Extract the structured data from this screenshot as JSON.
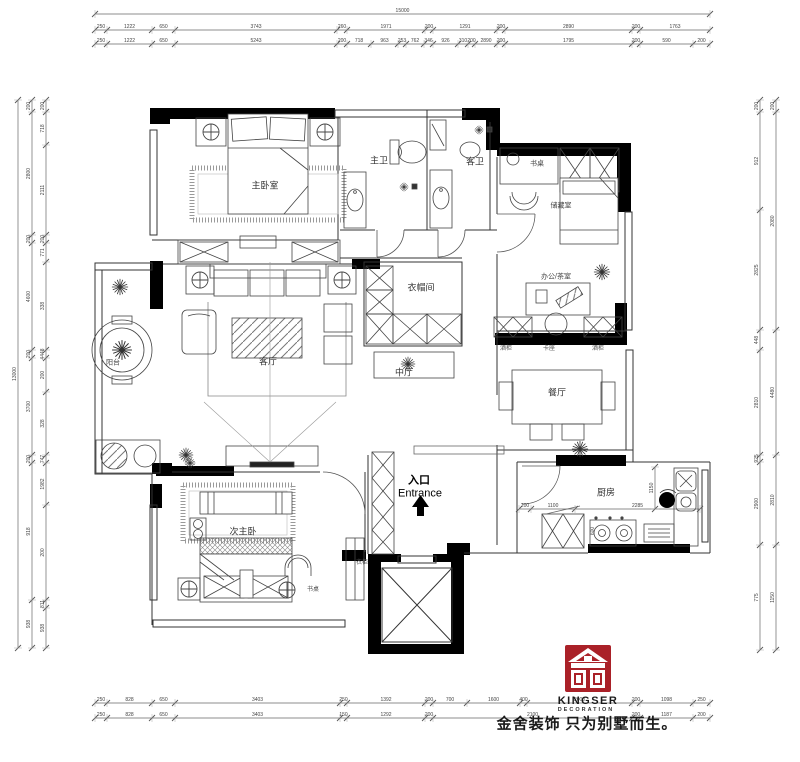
{
  "labels": {
    "master_bedroom": "主卧室",
    "master_bath": "主卫",
    "guest_bath": "客卫",
    "desk_top": "书桌",
    "storage_room": "储藏室",
    "cloakroom": "衣帽间",
    "office_tea": "办公/茶室",
    "living_room": "客厅",
    "mid_hall": "中厅",
    "wine_cabinet_left": "酒柜",
    "booth_seat": "卡座",
    "wine_cabinet_right": "酒柜",
    "dining_room": "餐厅",
    "balcony": "阳台",
    "second_master": "次主卧",
    "desk_bottom": "书桌",
    "wardrobe": "衣柜",
    "entry_cn": "入口",
    "entry_en": "Entrance",
    "kitchen": "厨房"
  },
  "logo": {
    "brand": "KINGSER",
    "sub": "DECORATION",
    "slogan": "金舍装饰 只为别墅而生。",
    "mark_color": "#aa2128"
  },
  "dimensions": {
    "rows": [
      {
        "dir": "h",
        "pos": 14,
        "ticks": [
          95,
          710
        ],
        "values": [
          "15000"
        ]
      },
      {
        "dir": "h",
        "pos": 30,
        "ticks": [
          95,
          107,
          152,
          175,
          337,
          347,
          425,
          433,
          497,
          505,
          632,
          640,
          710
        ],
        "values": [
          "250",
          "1222",
          "650",
          "3743",
          "260",
          "1971",
          "200",
          "1291",
          "200",
          "2890",
          "200",
          "1763"
        ]
      },
      {
        "dir": "h",
        "pos": 44,
        "ticks": [
          95,
          107,
          152,
          175,
          337,
          347,
          371,
          398,
          406,
          424,
          433,
          458,
          468,
          475,
          497,
          505,
          632,
          640,
          693,
          710
        ],
        "values": [
          "250",
          "1222",
          "650",
          "5243",
          "200",
          "718",
          "963",
          "253",
          "762",
          "346",
          "926",
          "310",
          "200",
          "2890",
          "200",
          "1795",
          "200",
          "590",
          "200"
        ]
      },
      {
        "dir": "h",
        "pos": 703,
        "ticks": [
          95,
          107,
          152,
          175,
          340,
          347,
          425,
          433,
          467,
          520,
          527,
          632,
          640,
          693,
          710
        ],
        "values": [
          "250",
          "828",
          "650",
          "3403",
          "250",
          "1392",
          "200",
          "700",
          "1600",
          "400",
          "2000",
          "200",
          "1098",
          "250"
        ]
      },
      {
        "dir": "h",
        "pos": 718,
        "ticks": [
          95,
          107,
          152,
          175,
          340,
          347,
          425,
          433,
          632,
          640,
          693,
          710
        ],
        "values": [
          "250",
          "828",
          "650",
          "3403",
          "150",
          "1292",
          "200",
          "2100",
          "200",
          "1187",
          "200"
        ]
      },
      {
        "dir": "v",
        "pos": 18,
        "ticks": [
          100,
          648
        ],
        "values": [
          "13000"
        ]
      },
      {
        "dir": "v",
        "pos": 32,
        "ticks": [
          100,
          112,
          235,
          243,
          350,
          358,
          455,
          463,
          600,
          648
        ],
        "values": [
          "200",
          "2800",
          "200",
          "4600",
          "200",
          "3700",
          "200",
          "918",
          "938"
        ]
      },
      {
        "dir": "v",
        "pos": 46,
        "ticks": [
          100,
          112,
          145,
          235,
          243,
          262,
          350,
          358,
          392,
          455,
          463,
          505,
          600,
          608,
          648
        ],
        "values": [
          "200",
          "718",
          "2111",
          "200",
          "771",
          "338",
          "4448",
          "200",
          "328",
          "747",
          "1982",
          "200",
          "811",
          "938"
        ]
      },
      {
        "dir": "v",
        "pos": 760,
        "ticks": [
          100,
          112,
          210,
          330,
          350,
          455,
          462,
          545,
          650
        ],
        "values": [
          "200",
          "912",
          "2825",
          "448",
          "2810",
          "925",
          "2900",
          "775"
        ]
      },
      {
        "dir": "v",
        "pos": 776,
        "ticks": [
          100,
          112,
          330,
          455,
          545,
          650
        ],
        "values": [
          "200",
          "2080",
          "4480",
          "2810",
          "1150"
        ]
      },
      {
        "dir": "h",
        "pos": 509,
        "ticks": [
          519,
          531,
          575,
          700
        ],
        "values": [
          "200",
          "1100",
          "2285"
        ]
      },
      {
        "dir": "v",
        "pos": 655,
        "ticks": [
          467,
          509
        ],
        "values": [
          "1150"
        ]
      }
    ],
    "free": [
      {
        "v": "600",
        "x": 594,
        "y": 531,
        "rot": -90
      }
    ]
  }
}
